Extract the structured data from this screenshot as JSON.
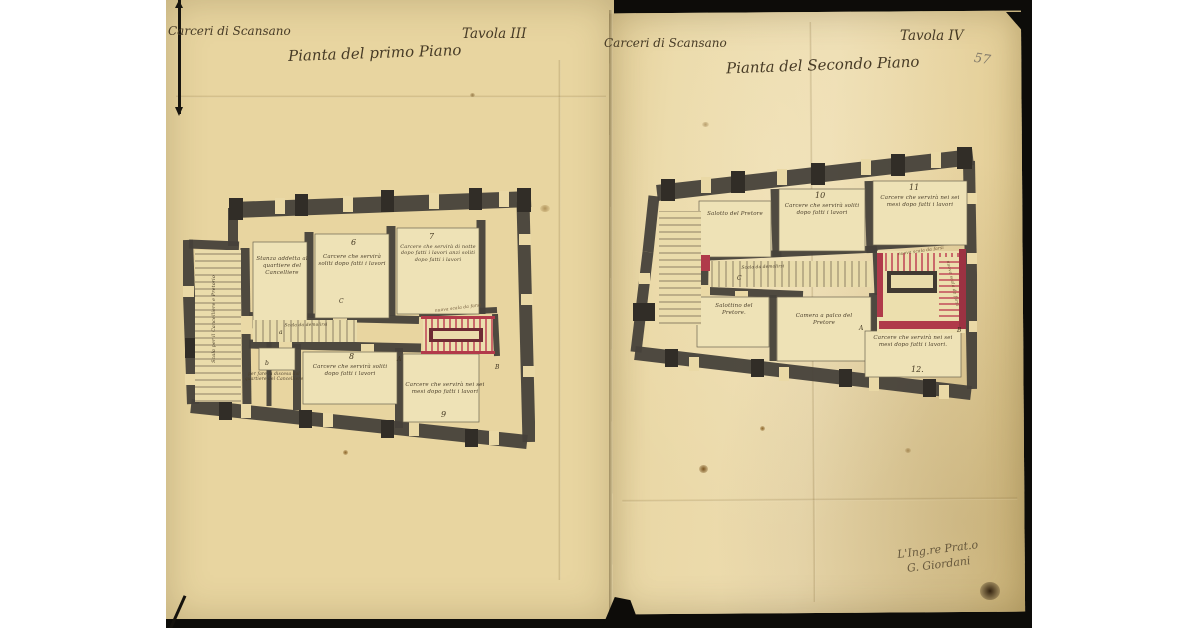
{
  "pages": {
    "left": {
      "header_collection": "Carceri di Scansano",
      "header_plate": "Tavola III",
      "title": "Pianta del primo Piano",
      "rooms": {
        "stairs_vertical": "Scala per il Cancelliere e Pretorio",
        "cancelliere": "Stanza addetta al quartiere del Cancelliere",
        "room6_num": "6",
        "room6": "Carcere che servirà soliti dopo fatti i lavori",
        "room7_num": "7",
        "room7": "Carcere che servirà di notte dopo fatti i lavori anzi soliti dopo fatti i lavori",
        "corridor_stairs": "Scala da demolirsi",
        "room8_num": "8",
        "room8": "Carcere che servirà soliti dopo fatti i lavori",
        "room9": "Carcere che servirà nei sei mesi dopo fatti i lavori",
        "room9_num": "9",
        "small_room_note": "per fare la discesa dal quartiere del Cancelliere",
        "new_stairs_note": "nuova scala da farsi",
        "marker_a": "a",
        "marker_b": "b",
        "marker_c": "C",
        "marker_A": "A",
        "marker_B": "B"
      }
    },
    "right": {
      "header_collection": "Carceri di Scansano",
      "header_plate": "Tavola IV",
      "title": "Pianta del Secondo Piano",
      "page_number_pencil": "57",
      "rooms": {
        "salotto": "Salotto del Pretore",
        "room10_num": "10",
        "room10": "Carcere che servirà soliti dopo fatti i lavori",
        "room11_num": "11",
        "room11": "Carcere che servirà nei sei mesi dopo fatti i lavori",
        "corridor_stairs": "Scala da demolirsi",
        "salottino": "Salottino del Pretore.",
        "camera": "Camera a palco del Pretore",
        "room12": "Carcere che servirà nei sei mesi dopo fatti i lavori.",
        "room12_num": "12.",
        "new_stairs_note": "nuova scala da farsi",
        "marker_C": "C",
        "marker_A": "A",
        "marker_B": "B"
      }
    }
  },
  "signature": {
    "line1": "L'Ing.re Prat.o",
    "line2": "G. Giordani"
  }
}
